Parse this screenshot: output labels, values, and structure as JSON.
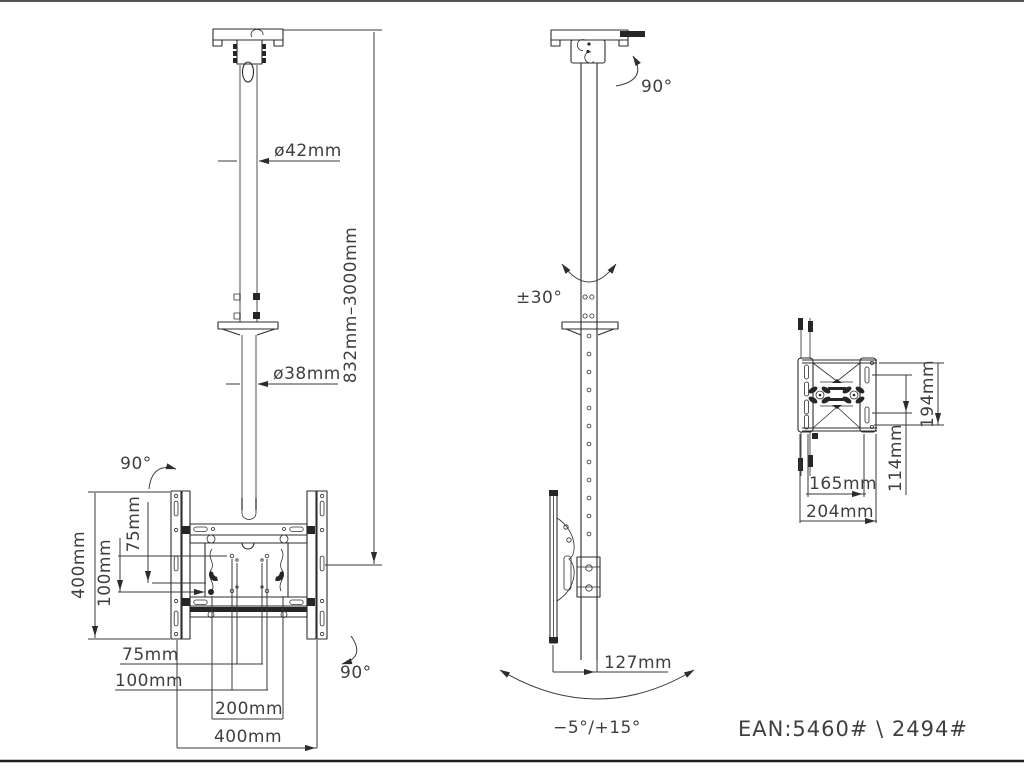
{
  "title": "ceiling-tv-mount-technical-drawing",
  "colors": {
    "background": "#ffffff",
    "line": "#2d2d2d",
    "pole_gray": "#989898",
    "text": "#3f3f3f"
  },
  "front": {
    "dia_upper": "ø42mm",
    "dia_lower": "ø38mm",
    "drop_range": "832mm–3000mm",
    "swivel_top": "90°",
    "swivel_bottom": "90°",
    "plate_height": "400mm",
    "vesa_v75": "75mm",
    "vesa_v100": "100mm",
    "vesa_h75": "75mm",
    "vesa_h100": "100mm",
    "vesa_h200": "200mm",
    "plate_width": "400mm"
  },
  "side": {
    "rotation_top": "90°",
    "swivel_range": "±30°",
    "depth": "127mm",
    "tilt_range": "−5°/+15°"
  },
  "top": {
    "height_194": "194mm",
    "spacing_114": "114mm",
    "width_165": "165mm",
    "width_204": "204mm"
  },
  "footer": {
    "ean": "EAN:5460# \\ 2494#"
  }
}
